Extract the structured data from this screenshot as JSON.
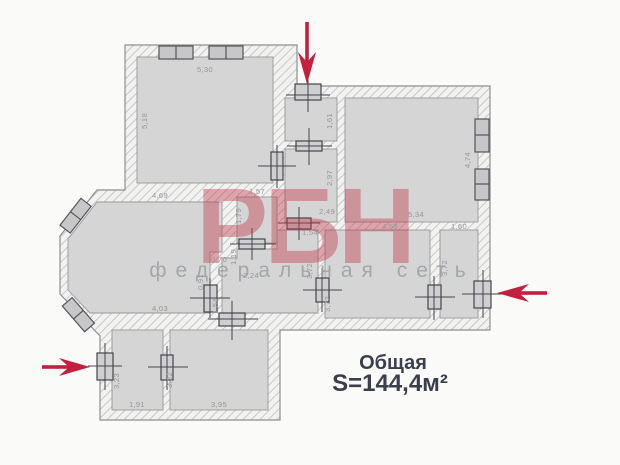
{
  "plan": {
    "summary": {
      "label": "Общая",
      "area": "S=144,4м²"
    },
    "watermark": {
      "brand": "РБН",
      "tagline": "федеральная сеть"
    },
    "dims": {
      "tl_w": "5,30",
      "tl_h": "5,18",
      "vest_h": "1,61",
      "hall_h": "2,97",
      "tr_h": "4,74",
      "tr_w": "5,34",
      "lv_top": "4,69",
      "lv_bottom": "4,03",
      "wc_w": "1,57",
      "wc_h": "1,79",
      "cor_w": "2,49",
      "door_w": "1,54",
      "f_w": "4,55",
      "g_w": "1,60",
      "cor_h": "3,72",
      "f_h": "3,72",
      "g_h": "3,72",
      "pass_w": "0,70",
      "pass_h": "1,19",
      "cor2_w": "2,24",
      "lv_door_a": "0,91",
      "lv_door_b": "1,54",
      "h_h": "3,23",
      "h_w": "1,91",
      "i_h": "3,22",
      "i_w": "3,95"
    },
    "colors": {
      "arrow_red": "#c41f3e",
      "watermark_pink": "#c23a4c",
      "tagline_gray": "#9aa0a1",
      "summary_text": "#3a3f4b",
      "room_fill": "#d5d5d6",
      "dim_text": "#97979a"
    }
  }
}
